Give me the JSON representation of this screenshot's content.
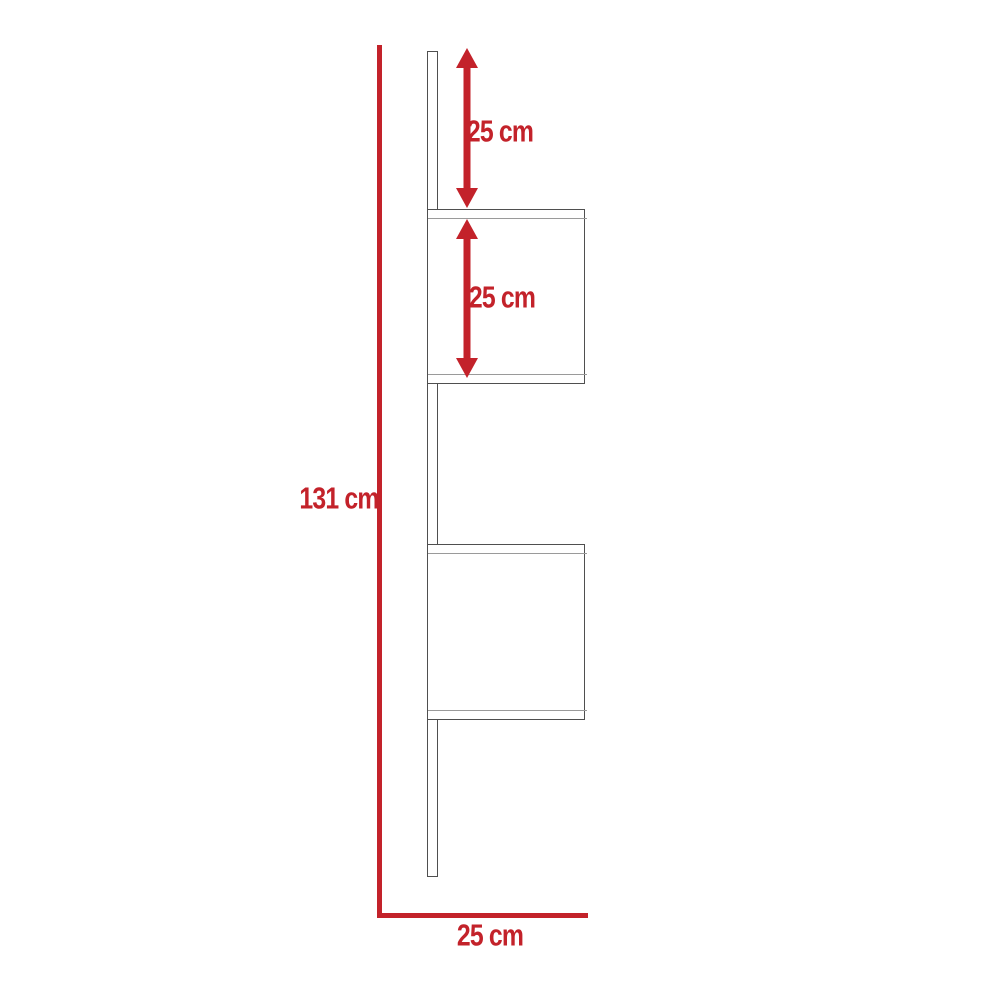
{
  "diagram": {
    "type": "furniture-dimension-diagram",
    "subject": "wall-mounted ladder shelf with two box shelves",
    "labels": {
      "top_segment": "25 cm",
      "shelf_segment": "25 cm",
      "total_height": "131 cm",
      "base_width": "25 cm"
    },
    "dimensions": [
      {
        "id": "top-segment",
        "value": "25 cm",
        "orientation": "vertical",
        "described": "gap from top of upright to first shelf"
      },
      {
        "id": "shelf-segment",
        "value": "25 cm",
        "orientation": "vertical",
        "described": "height of upper box shelf"
      },
      {
        "id": "total-height",
        "value": "131 cm",
        "orientation": "vertical",
        "described": "overall height"
      },
      {
        "id": "base-width",
        "value": "25 cm",
        "orientation": "horizontal",
        "described": "overall depth/width"
      }
    ],
    "colors": {
      "red": "#c3222a",
      "outline_dark": "#4f4f4f",
      "outline_light": "#9a9a9a",
      "bg": "#ffffff"
    }
  }
}
